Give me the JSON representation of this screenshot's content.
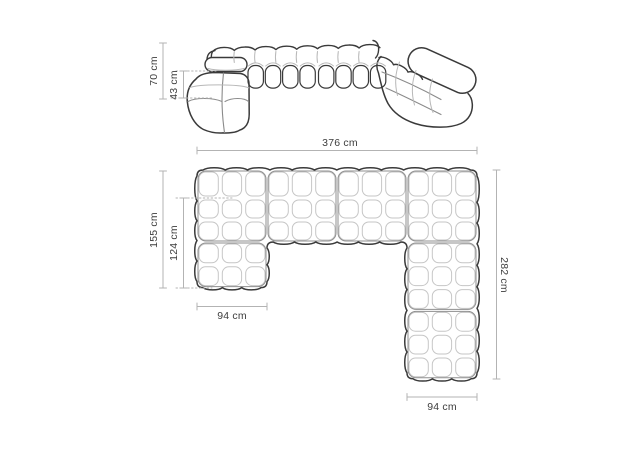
{
  "diagram": {
    "subject": "modular-corner-sofa-dimension-diagram",
    "unit": "cm",
    "colors": {
      "background": "#ffffff",
      "outline": "#3a3a3a",
      "module_line": "#8f8f8f",
      "cell_line": "#c6c6c6",
      "inner_medium_line": "#8a8a8a",
      "inner_light_line": "#b8b8b8",
      "dimension_line": "#b3b3b3",
      "label_text": "#3d3d3d"
    },
    "front_view": {
      "name": "sofa front perspective view",
      "dimensions": {
        "total_height": {
          "label": "70 cm",
          "value": 70
        },
        "seat_height": {
          "label": "43 cm",
          "value": 43
        }
      }
    },
    "top_view": {
      "name": "sofa top plan view",
      "dimensions": {
        "total_width": {
          "label": "376 cm",
          "value": 376
        },
        "left_depth": {
          "label": "155 cm",
          "value": 155
        },
        "left_inner_depth": {
          "label": "124 cm",
          "value": 124
        },
        "left_arm_width": {
          "label": "94 cm",
          "value": 94
        },
        "right_depth": {
          "label": "282 cm",
          "value": 282
        },
        "right_arm_width": {
          "label": "94 cm",
          "value": 94
        }
      }
    }
  }
}
